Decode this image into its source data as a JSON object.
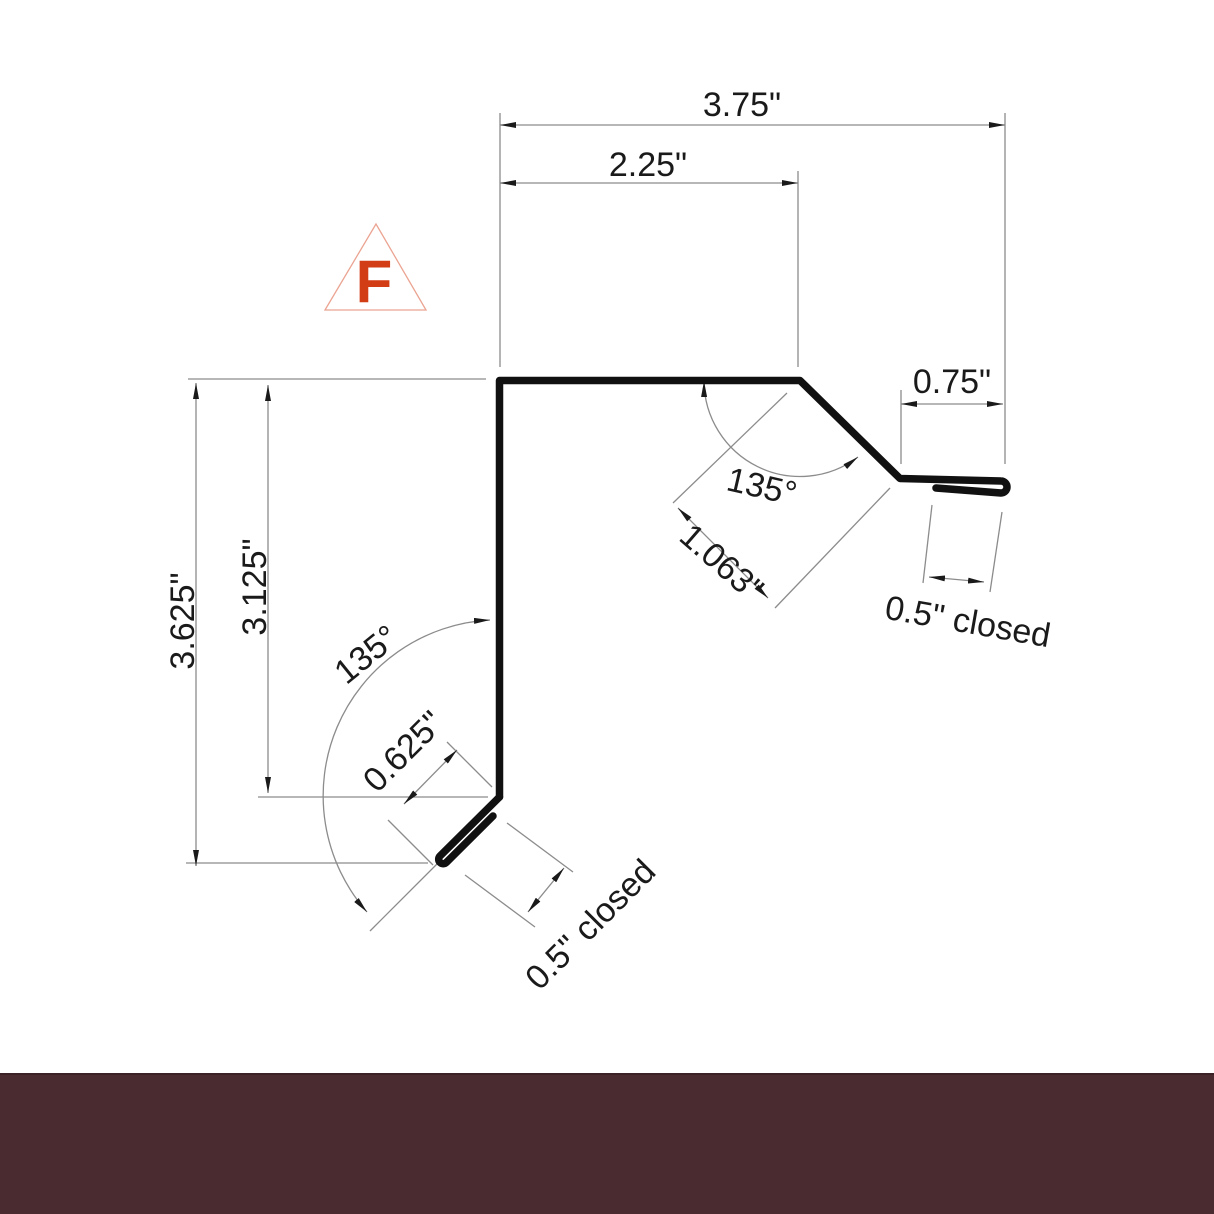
{
  "drawing": {
    "title": "F flashing profile drawing",
    "marker": {
      "letter": "F"
    },
    "labels": {
      "overall_width": "3.75\"",
      "top_flange": "2.25\"",
      "right_kick": "0.75\"",
      "overall_height": "3.625\"",
      "face_height": "3.125\"",
      "right_diagonal": "1.063\"",
      "top_angle": "135°",
      "bottom_angle": "135°",
      "bottom_kick": "0.625\"",
      "right_hem": "0.5\" closed",
      "bottom_hem": "0.5\" closed"
    },
    "colors": {
      "profile": "#111111",
      "dimension_lines": "#8c8c8c",
      "arrows": "#1a1a1a",
      "text": "#1a1a1a",
      "marker_letter": "#d33d15",
      "marker_triangle": "#eba492",
      "footer_bar": "#4a2c30",
      "footer_bar_edge": "#3a2226",
      "background": "#ffffff"
    }
  }
}
